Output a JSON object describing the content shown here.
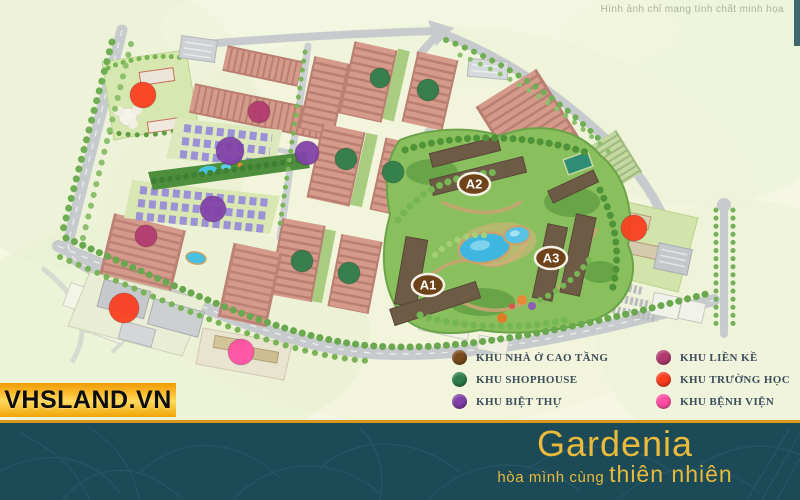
{
  "disclaimer": {
    "text": "Hình ảnh chỉ mang tính chất minh họa"
  },
  "watermark": {
    "text": "VHSLAND.VN"
  },
  "footer": {
    "brand": "Gardenia",
    "slogan_prefix": "hòa mình cùng",
    "slogan_emphasis": "thiên nhiên",
    "band_color": "#1c4b57",
    "accent_color": "#e9ba3c"
  },
  "legend": {
    "items": [
      {
        "key": "cao-tang",
        "label": "KHU NHÀ Ở CAO TẦNG",
        "color": "#7b4a1e"
      },
      {
        "key": "shophouse",
        "label": "KHU SHOPHOUSE",
        "color": "#2e7d4a"
      },
      {
        "key": "biet-thu",
        "label": "KHU BIỆT THỰ",
        "color": "#8040a8"
      },
      {
        "key": "lien-ke",
        "label": "KHU LIỀN KỀ",
        "color": "#b23a70"
      },
      {
        "key": "truong-hoc",
        "label": "KHU TRƯỜNG HỌC",
        "color": "#fb3d1e"
      },
      {
        "key": "benh-vien",
        "label": "KHU BỆNH VIỆN",
        "color": "#ff4fa3"
      }
    ]
  },
  "map": {
    "markers": [
      {
        "id": "A1",
        "x": 428,
        "y": 285
      },
      {
        "id": "A2",
        "x": 474,
        "y": 184
      },
      {
        "id": "A3",
        "x": 551,
        "y": 258
      }
    ],
    "marker_fill": "#6f4319",
    "zone_colors": {
      "truong-hoc": "#fb3d1e",
      "lien-ke": "#b23a70",
      "biet-thu": "#8040a8",
      "benh-vien": "#ff4fa3",
      "shophouse": "#2e7d4a",
      "cao-tang": "#7b4a1e"
    },
    "zone_dots": [
      {
        "type": "truong-hoc",
        "x": 143,
        "y": 95,
        "r": 13
      },
      {
        "type": "lien-ke",
        "x": 259,
        "y": 112,
        "r": 11
      },
      {
        "type": "biet-thu",
        "x": 230,
        "y": 151,
        "r": 14
      },
      {
        "type": "biet-thu",
        "x": 307,
        "y": 153,
        "r": 12
      },
      {
        "type": "biet-thu",
        "x": 213,
        "y": 209,
        "r": 13
      },
      {
        "type": "lien-ke",
        "x": 146,
        "y": 236,
        "r": 11
      },
      {
        "type": "truong-hoc",
        "x": 124,
        "y": 308,
        "r": 15
      },
      {
        "type": "benh-vien",
        "x": 241,
        "y": 352,
        "r": 13
      },
      {
        "type": "truong-hoc",
        "x": 634,
        "y": 228,
        "r": 13
      },
      {
        "type": "shophouse",
        "x": 380,
        "y": 78,
        "r": 10
      },
      {
        "type": "shophouse",
        "x": 428,
        "y": 90,
        "r": 11
      },
      {
        "type": "shophouse",
        "x": 346,
        "y": 159,
        "r": 11
      },
      {
        "type": "shophouse",
        "x": 393,
        "y": 172,
        "r": 11
      },
      {
        "type": "shophouse",
        "x": 302,
        "y": 261,
        "r": 11
      },
      {
        "type": "shophouse",
        "x": 349,
        "y": 273,
        "r": 11
      }
    ]
  }
}
